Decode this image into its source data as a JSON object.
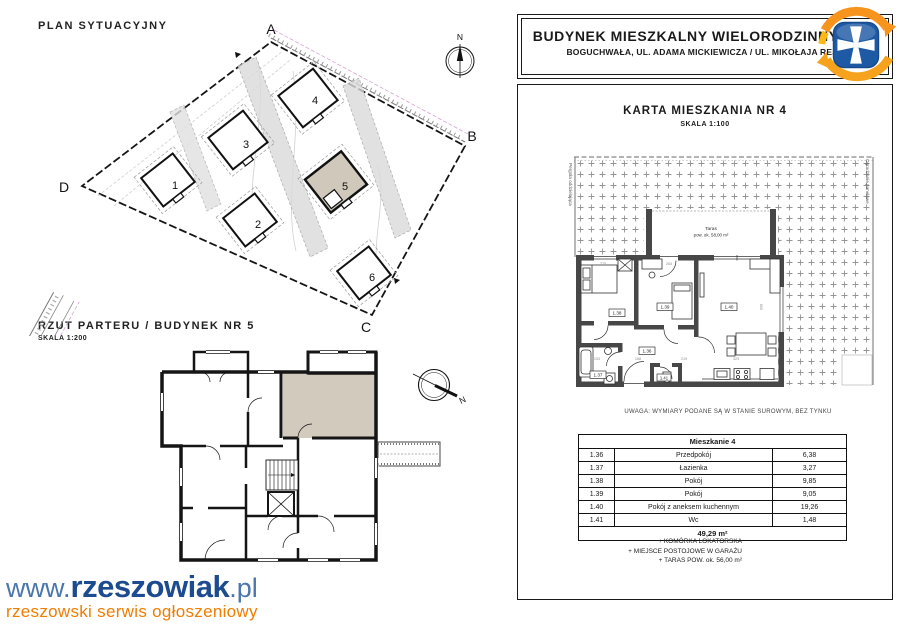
{
  "header": {
    "title": "BUDYNEK MIESZKALNY WIELORODZINNY NR 5",
    "subtitle": "BOGUCHWAŁA, UL. ADAMA MICKIEWICZA / UL. MIKOŁAJA REJA"
  },
  "site_plan": {
    "title": "PLAN SYTUACYJNY",
    "streets": {
      "mickiewicza": "ULICA ADAMA MICKIEWICZA",
      "reja": "ULICA MIKOŁAJA REJA"
    },
    "corners": {
      "a": "A",
      "b": "B",
      "c": "C",
      "d": "D"
    },
    "buildings": {
      "b1": "1",
      "b2": "2",
      "b3": "3",
      "b4": "4",
      "b5": "5",
      "b6": "6"
    },
    "highlighted_building": "5",
    "compass_n": "N"
  },
  "floor_plan": {
    "title": "RZUT PARTERU / BUDYNEK NR 5",
    "scale": "SKALA 1:200",
    "compass_n": "N"
  },
  "apartment": {
    "title": "KARTA MIESZKANIA NR 4",
    "scale": "SKALA 1:100",
    "terrace_line1": "Taras",
    "terrace_line2": "pow. ok. 58,00 m²",
    "pergola": "Pergola oddzielająca",
    "fence": "Ogrodzenie panelowe",
    "note": "UWAGA: WYMIARY PODANE SĄ W STANIE SUROWYM, BEZ TYNKU",
    "labels": {
      "r136": "1.36",
      "r137": "1.37",
      "r138": "1.38",
      "r139": "1.39",
      "r140": "1.40",
      "r141": "1.41"
    },
    "dims": {
      "d275": "275",
      "d263": "263",
      "d805": "805",
      "d153": "153",
      "d168": "168",
      "d219": "219",
      "d323": "323"
    }
  },
  "table": {
    "header": "Mieszkanie 4",
    "rows": [
      {
        "no": "1.36",
        "name": "Przedpokój",
        "area": "6,38"
      },
      {
        "no": "1.37",
        "name": "Łazienka",
        "area": "3,27"
      },
      {
        "no": "1.38",
        "name": "Pokój",
        "area": "9,85"
      },
      {
        "no": "1.39",
        "name": "Pokój",
        "area": "9,05"
      },
      {
        "no": "1.40",
        "name": "Pokój z aneksem kuchennym",
        "area": "19,26"
      },
      {
        "no": "1.41",
        "name": "Wc",
        "area": "1,48"
      }
    ],
    "total": "49,29 m²",
    "extras": [
      "+ KOMÓRKA LOKATORSKA",
      "+ MIEJSCE POSTOJOWE W GARAŻU",
      "+ TARAS POW. ok. 56,00 m²"
    ]
  },
  "branding": {
    "www": "www.",
    "name": "rzeszowiak",
    "tld": ".pl",
    "tagline": "rzeszowski serwis ogłoszeniowy"
  },
  "colors": {
    "highlight_beige": "#cfc8bb",
    "brand_navy": "#1d4b8f",
    "brand_blue": "#4a76ad",
    "brand_orange": "#ef7d00",
    "crest_blue": "#1e5aa4",
    "crest_orange": "#f7941d"
  }
}
